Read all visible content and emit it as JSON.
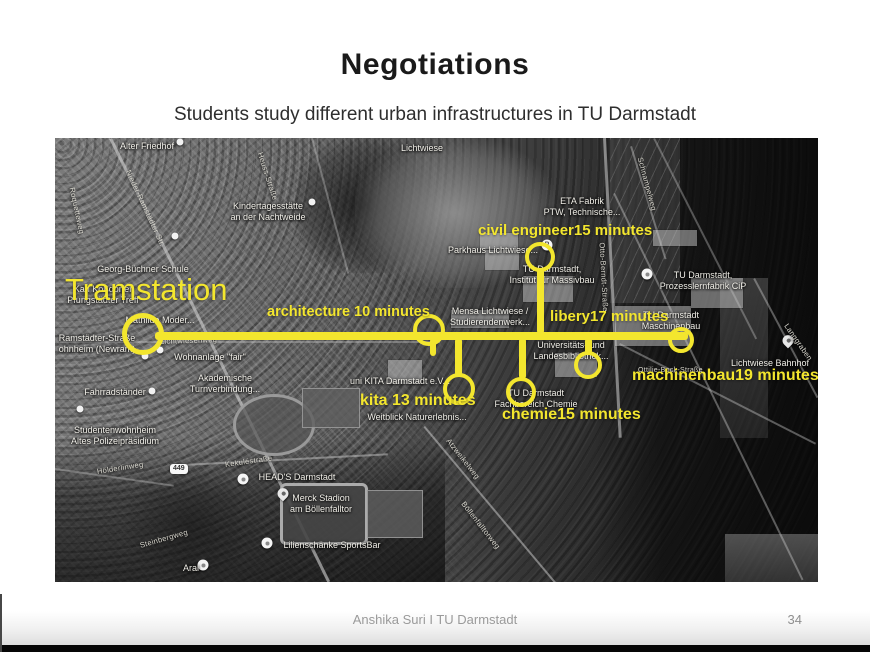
{
  "slide": {
    "title": "Negotiations",
    "subtitle": "Students study different urban infrastructures in TU Darmstadt",
    "footer": "Anshika Suri I TU Darmstadt",
    "page_number": "34"
  },
  "colors": {
    "annotation_yellow": "#f3e62e",
    "map_label": "#f1efe8"
  },
  "map": {
    "road_badge": "449",
    "annotations": {
      "labels": [
        {
          "text": "Tramstation",
          "x": 10,
          "y": 134,
          "size": 31,
          "weight": 400
        },
        {
          "text": "architecture 10 minutes",
          "x": 212,
          "y": 166,
          "size": 14.5
        },
        {
          "text": "civil engineer15 minutes",
          "x": 423,
          "y": 84,
          "size": 15
        },
        {
          "text": "libery17 minutes",
          "x": 495,
          "y": 170,
          "size": 15
        },
        {
          "text": "machinenbau19 minutes",
          "x": 577,
          "y": 229,
          "size": 16
        },
        {
          "text": "kita 13 minutes",
          "x": 305,
          "y": 254,
          "size": 16
        },
        {
          "text": "chemie15 minutes",
          "x": 447,
          "y": 268,
          "size": 16
        }
      ],
      "route_lines": [
        {
          "x": 100,
          "y": 194,
          "w": 533,
          "h": 8
        },
        {
          "x": 482,
          "y": 130,
          "w": 7,
          "h": 66
        },
        {
          "x": 400,
          "y": 200,
          "w": 7,
          "h": 38
        },
        {
          "x": 464,
          "y": 200,
          "w": 7,
          "h": 41
        },
        {
          "x": 530,
          "y": 200,
          "w": 7,
          "h": 16
        },
        {
          "x": 375,
          "y": 200,
          "w": 6,
          "h": 18
        }
      ],
      "route_circles": [
        {
          "x": 88,
          "y": 196,
          "r": 21,
          "b": 5
        },
        {
          "x": 374,
          "y": 192,
          "r": 16,
          "b": 4
        },
        {
          "x": 485,
          "y": 119,
          "r": 15,
          "b": 4
        },
        {
          "x": 404,
          "y": 251,
          "r": 16,
          "b": 4
        },
        {
          "x": 466,
          "y": 254,
          "r": 15,
          "b": 4
        },
        {
          "x": 533,
          "y": 227,
          "r": 14,
          "b": 4
        },
        {
          "x": 626,
          "y": 202,
          "r": 13,
          "b": 4
        }
      ]
    },
    "places": [
      {
        "lines": [
          "Alter Friedhof"
        ],
        "x": 92,
        "y": 3
      },
      {
        "lines": [
          "Kindertagesstätte",
          "an der Nachtweide"
        ],
        "x": 213,
        "y": 63
      },
      {
        "lines": [
          "Georg-Büchner Schule"
        ],
        "x": 88,
        "y": 126
      },
      {
        "lines": [
          "Karl Koßdorfer",
          "Pfungstädter Treff"
        ],
        "x": 48,
        "y": 146
      },
      {
        "lines": [
          "Mathilde Moder..."
        ],
        "x": 105,
        "y": 177
      },
      {
        "lines": [
          "Ramstädter-Straße",
          "ohnheim (Newram)"
        ],
        "x": 42,
        "y": 195
      },
      {
        "lines": [
          "Wohnanlage \"fair\""
        ],
        "x": 155,
        "y": 214
      },
      {
        "lines": [
          "Akademische",
          "Turnverbindung..."
        ],
        "x": 170,
        "y": 235
      },
      {
        "lines": [
          "Fahrradständer"
        ],
        "x": 60,
        "y": 249
      },
      {
        "lines": [
          "Studentenwohnheim",
          "Altes Polizeipräsidium"
        ],
        "x": 60,
        "y": 287
      },
      {
        "lines": [
          "HEAD'S Darmstadt"
        ],
        "x": 242,
        "y": 334
      },
      {
        "lines": [
          "Merck Stadion",
          "am Böllenfalltor"
        ],
        "x": 266,
        "y": 355
      },
      {
        "lines": [
          "Lilienschänke SportsBar"
        ],
        "x": 277,
        "y": 402
      },
      {
        "lines": [
          "Aral"
        ],
        "x": 136,
        "y": 425
      },
      {
        "lines": [
          "Lichtwiese"
        ],
        "x": 367,
        "y": 5
      },
      {
        "lines": [
          "ETA Fabrik",
          "PTW, Technische..."
        ],
        "x": 527,
        "y": 58
      },
      {
        "lines": [
          "Parkhaus Lichtwiese..."
        ],
        "x": 438,
        "y": 107
      },
      {
        "lines": [
          "TU Darmstadt,",
          "Institut für Massivbau"
        ],
        "x": 497,
        "y": 126
      },
      {
        "lines": [
          "TU Darmstadt,",
          "Prozesslernfabrik CiP"
        ],
        "x": 648,
        "y": 132
      },
      {
        "lines": [
          "Mensa Lichtwiese /",
          "Studierendenwerk..."
        ],
        "x": 435,
        "y": 168
      },
      {
        "lines": [
          "TU Darmstadt",
          "Maschinenbau"
        ],
        "x": 616,
        "y": 172
      },
      {
        "lines": [
          "Universitäts- und",
          "Landesbibliothek..."
        ],
        "x": 516,
        "y": 202
      },
      {
        "lines": [
          "Lichtwiese Bahnhof"
        ],
        "x": 715,
        "y": 220
      },
      {
        "lines": [
          "TU Darmstadt",
          "Fachbereich Chemie"
        ],
        "x": 481,
        "y": 250
      },
      {
        "lines": [
          "uni KITA Darmstadt e.V..."
        ],
        "x": 345,
        "y": 238
      },
      {
        "lines": [
          "Weitblick Naturerlebnis..."
        ],
        "x": 362,
        "y": 274
      }
    ],
    "streets": [
      {
        "text": "Nieder-Ramstädter Str.",
        "x": 73,
        "y": 28,
        "rot": 65
      },
      {
        "text": "Roquetteweg",
        "x": 17,
        "y": 45,
        "rot": 78
      },
      {
        "text": "Heuss-Straße",
        "x": 205,
        "y": 10,
        "rot": 72
      },
      {
        "text": "Lichtwiesenweg",
        "x": 105,
        "y": 199,
        "rot": -2
      },
      {
        "text": "Hölderlinweg",
        "x": 42,
        "y": 329,
        "rot": -9
      },
      {
        "text": "Kekuléstraße",
        "x": 170,
        "y": 322,
        "rot": -8
      },
      {
        "text": "Steinbergweg",
        "x": 85,
        "y": 403,
        "rot": -16
      },
      {
        "text": "Schnampelweg",
        "x": 585,
        "y": 15,
        "rot": 75
      },
      {
        "text": "Otto-Berndt-Straße",
        "x": 547,
        "y": 100,
        "rot": 87
      },
      {
        "text": "Langgraben",
        "x": 731,
        "y": 182,
        "rot": 55
      },
      {
        "text": "Böllenfalltorweg",
        "x": 408,
        "y": 360,
        "rot": 52
      },
      {
        "text": "Atzweikelweg",
        "x": 393,
        "y": 297,
        "rot": 52
      },
      {
        "text": "Ottilie-Bock-Straße",
        "x": 583,
        "y": 229,
        "rot": 0,
        "size": 7
      }
    ],
    "pins": [
      {
        "x": 125,
        "y": 4,
        "t": "dot"
      },
      {
        "x": 257,
        "y": 64,
        "t": "dot"
      },
      {
        "x": 120,
        "y": 98,
        "t": "dot"
      },
      {
        "x": 105,
        "y": 212,
        "t": "dot"
      },
      {
        "x": 90,
        "y": 218,
        "t": "dot"
      },
      {
        "x": 97,
        "y": 253,
        "t": "dot"
      },
      {
        "x": 25,
        "y": 271,
        "t": "dot"
      },
      {
        "x": 188,
        "y": 341,
        "t": "poi"
      },
      {
        "x": 228,
        "y": 360,
        "t": "pin"
      },
      {
        "x": 212,
        "y": 405,
        "t": "poi"
      },
      {
        "x": 148,
        "y": 427,
        "t": "poi"
      },
      {
        "x": 492,
        "y": 107,
        "t": "poi",
        "ch": "P"
      },
      {
        "x": 592,
        "y": 136,
        "t": "poi"
      },
      {
        "x": 733,
        "y": 207,
        "t": "pin"
      }
    ]
  }
}
